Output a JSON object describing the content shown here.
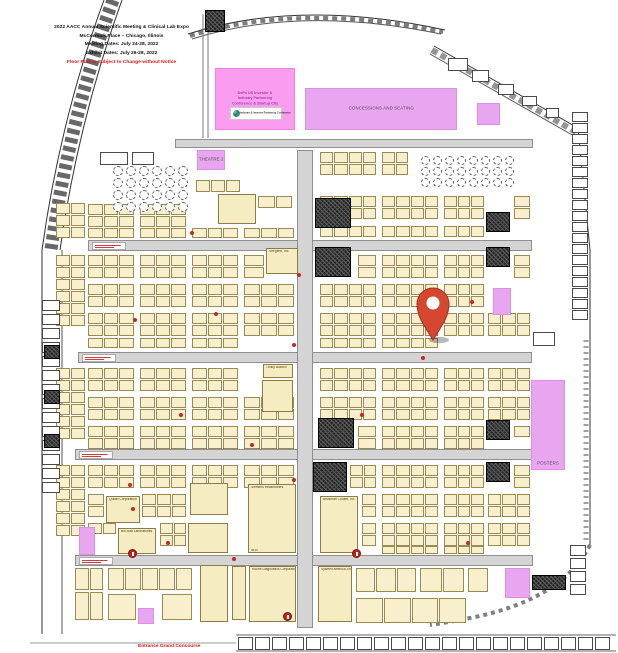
{
  "title": {
    "line1": "2022 AACC Annual Scientific Meeting & Clinical Lab Expo",
    "line2": "McCormick Place – Chicago, Illinois",
    "line3": "Meeting Dates: July 24-28, 2022",
    "line4": "Exhibit Dates: July 26-28, 2022",
    "notice": "Floor Plan is Subject to Change without Notice"
  },
  "labels": {
    "entrance": "Entrance Grand Concourse",
    "concessions": "CONCESSIONS AND SEATING",
    "theatre2": "THEATRE 2",
    "posters": "POSTERS",
    "dxpx_line1": "DxPx US Investor &",
    "dxpx_line2": "Industry Partnering",
    "dxpx_line3": "Conference & Startup City",
    "dxpx_logo": "Industry & Investor Partnering Conference"
  },
  "colors": {
    "booth_fill": "#f8efcd",
    "booth_border": "#9c8a52",
    "aisle_gray": "#d4d4d4",
    "zone_purple": "#e9a6f0",
    "zone_pink": "#fa9df0",
    "alert_red": "#e01212",
    "pin_red": "#d5472f"
  },
  "aisles": [
    [
      175,
      139,
      358,
      9
    ],
    [
      88,
      240,
      444,
      11
    ],
    [
      78,
      352,
      454,
      11
    ],
    [
      75,
      449,
      460,
      11
    ],
    [
      75,
      555,
      458,
      11
    ],
    [
      297,
      150,
      16,
      478
    ]
  ],
  "aisle_signs": [
    [
      92,
      242,
      34
    ],
    [
      82,
      354,
      34
    ],
    [
      79,
      451,
      34
    ],
    [
      79,
      557,
      34
    ]
  ],
  "strips": [
    [
      88,
      204,
      46,
      11,
      3
    ],
    [
      140,
      204,
      46,
      11,
      3
    ],
    [
      88,
      216,
      46,
      11,
      3
    ],
    [
      140,
      216,
      46,
      11,
      3
    ],
    [
      88,
      228,
      46,
      10,
      3
    ],
    [
      140,
      228,
      46,
      10,
      3
    ],
    [
      192,
      228,
      46,
      10,
      3
    ],
    [
      244,
      228,
      50,
      10,
      3
    ],
    [
      196,
      180,
      44,
      12,
      3
    ],
    [
      258,
      196,
      34,
      12,
      2
    ],
    [
      320,
      152,
      56,
      11,
      4
    ],
    [
      382,
      152,
      26,
      11,
      2
    ],
    [
      320,
      164,
      56,
      11,
      4
    ],
    [
      382,
      164,
      26,
      11,
      2
    ],
    [
      320,
      196,
      56,
      11,
      4
    ],
    [
      382,
      196,
      56,
      11,
      4
    ],
    [
      444,
      196,
      40,
      11,
      3
    ],
    [
      514,
      196,
      16,
      11,
      1
    ],
    [
      320,
      208,
      56,
      11,
      4
    ],
    [
      382,
      208,
      56,
      11,
      4
    ],
    [
      444,
      208,
      40,
      11,
      3
    ],
    [
      514,
      208,
      16,
      11,
      1
    ],
    [
      320,
      226,
      56,
      11,
      4
    ],
    [
      382,
      226,
      56,
      11,
      4
    ],
    [
      444,
      226,
      40,
      11,
      3
    ],
    [
      88,
      255,
      46,
      11,
      3
    ],
    [
      140,
      255,
      46,
      11,
      3
    ],
    [
      192,
      255,
      46,
      11,
      3
    ],
    [
      244,
      255,
      20,
      11,
      1
    ],
    [
      88,
      267,
      46,
      11,
      3
    ],
    [
      140,
      267,
      46,
      11,
      3
    ],
    [
      192,
      267,
      46,
      11,
      3
    ],
    [
      244,
      267,
      20,
      11,
      1
    ],
    [
      358,
      255,
      18,
      11,
      1
    ],
    [
      382,
      255,
      56,
      11,
      4
    ],
    [
      444,
      255,
      40,
      11,
      3
    ],
    [
      514,
      255,
      16,
      11,
      1
    ],
    [
      358,
      267,
      18,
      11,
      1
    ],
    [
      382,
      267,
      56,
      11,
      4
    ],
    [
      444,
      267,
      40,
      11,
      3
    ],
    [
      514,
      267,
      16,
      11,
      1
    ],
    [
      88,
      284,
      46,
      11,
      3
    ],
    [
      140,
      284,
      46,
      11,
      3
    ],
    [
      192,
      284,
      46,
      11,
      3
    ],
    [
      244,
      284,
      50,
      11,
      3
    ],
    [
      320,
      284,
      56,
      11,
      4
    ],
    [
      382,
      284,
      56,
      11,
      4
    ],
    [
      444,
      284,
      40,
      11,
      3
    ],
    [
      88,
      296,
      46,
      11,
      3
    ],
    [
      140,
      296,
      46,
      11,
      3
    ],
    [
      192,
      296,
      46,
      11,
      3
    ],
    [
      244,
      296,
      50,
      11,
      3
    ],
    [
      320,
      296,
      56,
      11,
      4
    ],
    [
      382,
      296,
      56,
      11,
      4
    ],
    [
      444,
      296,
      40,
      11,
      3
    ],
    [
      88,
      313,
      46,
      11,
      3
    ],
    [
      140,
      313,
      46,
      11,
      3
    ],
    [
      192,
      313,
      46,
      11,
      3
    ],
    [
      244,
      313,
      50,
      11,
      3
    ],
    [
      320,
      313,
      56,
      11,
      4
    ],
    [
      382,
      313,
      56,
      11,
      4
    ],
    [
      444,
      313,
      40,
      11,
      3
    ],
    [
      488,
      313,
      42,
      11,
      3
    ],
    [
      88,
      325,
      46,
      11,
      3
    ],
    [
      140,
      325,
      46,
      11,
      3
    ],
    [
      192,
      325,
      46,
      11,
      3
    ],
    [
      244,
      325,
      50,
      11,
      3
    ],
    [
      320,
      325,
      56,
      11,
      4
    ],
    [
      382,
      325,
      56,
      11,
      4
    ],
    [
      444,
      325,
      40,
      11,
      3
    ],
    [
      488,
      325,
      42,
      11,
      3
    ],
    [
      88,
      338,
      46,
      10,
      3
    ],
    [
      140,
      338,
      46,
      10,
      3
    ],
    [
      192,
      338,
      46,
      10,
      3
    ],
    [
      320,
      338,
      56,
      10,
      4
    ],
    [
      382,
      338,
      56,
      10,
      4
    ],
    [
      88,
      368,
      46,
      11,
      3
    ],
    [
      140,
      368,
      46,
      11,
      3
    ],
    [
      192,
      368,
      46,
      11,
      3
    ],
    [
      320,
      368,
      56,
      11,
      4
    ],
    [
      382,
      368,
      56,
      11,
      4
    ],
    [
      444,
      368,
      40,
      11,
      3
    ],
    [
      488,
      368,
      42,
      11,
      3
    ],
    [
      88,
      380,
      46,
      11,
      3
    ],
    [
      140,
      380,
      46,
      11,
      3
    ],
    [
      192,
      380,
      46,
      11,
      3
    ],
    [
      320,
      380,
      56,
      11,
      4
    ],
    [
      382,
      380,
      56,
      11,
      4
    ],
    [
      444,
      380,
      40,
      11,
      3
    ],
    [
      488,
      380,
      42,
      11,
      3
    ],
    [
      88,
      397,
      46,
      11,
      3
    ],
    [
      140,
      397,
      46,
      11,
      3
    ],
    [
      192,
      397,
      46,
      11,
      3
    ],
    [
      244,
      397,
      50,
      11,
      3
    ],
    [
      320,
      397,
      56,
      11,
      4
    ],
    [
      382,
      397,
      56,
      11,
      4
    ],
    [
      444,
      397,
      40,
      11,
      3
    ],
    [
      488,
      397,
      42,
      11,
      3
    ],
    [
      88,
      409,
      46,
      11,
      3
    ],
    [
      140,
      409,
      46,
      11,
      3
    ],
    [
      192,
      409,
      46,
      11,
      3
    ],
    [
      244,
      409,
      50,
      11,
      3
    ],
    [
      320,
      409,
      56,
      11,
      4
    ],
    [
      382,
      409,
      56,
      11,
      4
    ],
    [
      444,
      409,
      40,
      11,
      3
    ],
    [
      488,
      409,
      42,
      11,
      3
    ],
    [
      88,
      426,
      46,
      11,
      3
    ],
    [
      140,
      426,
      46,
      11,
      3
    ],
    [
      192,
      426,
      46,
      11,
      3
    ],
    [
      244,
      426,
      50,
      11,
      3
    ],
    [
      358,
      426,
      18,
      11,
      1
    ],
    [
      382,
      426,
      56,
      11,
      4
    ],
    [
      444,
      426,
      40,
      11,
      3
    ],
    [
      514,
      426,
      16,
      11,
      1
    ],
    [
      88,
      438,
      46,
      11,
      3
    ],
    [
      140,
      438,
      46,
      11,
      3
    ],
    [
      192,
      438,
      46,
      11,
      3
    ],
    [
      244,
      438,
      50,
      11,
      3
    ],
    [
      358,
      438,
      18,
      11,
      1
    ],
    [
      382,
      438,
      56,
      11,
      4
    ],
    [
      444,
      438,
      40,
      11,
      3
    ],
    [
      88,
      465,
      46,
      11,
      3
    ],
    [
      140,
      465,
      46,
      11,
      3
    ],
    [
      192,
      465,
      46,
      11,
      3
    ],
    [
      244,
      465,
      50,
      11,
      3
    ],
    [
      350,
      465,
      26,
      11,
      2
    ],
    [
      382,
      465,
      56,
      11,
      4
    ],
    [
      444,
      465,
      40,
      11,
      3
    ],
    [
      514,
      465,
      16,
      11,
      1
    ],
    [
      88,
      477,
      46,
      11,
      3
    ],
    [
      140,
      477,
      46,
      11,
      3
    ],
    [
      192,
      477,
      46,
      11,
      3
    ],
    [
      244,
      477,
      50,
      11,
      3
    ],
    [
      350,
      477,
      26,
      11,
      2
    ],
    [
      382,
      477,
      56,
      11,
      4
    ],
    [
      444,
      477,
      40,
      11,
      3
    ],
    [
      514,
      477,
      16,
      11,
      1
    ],
    [
      88,
      494,
      16,
      11,
      1
    ],
    [
      142,
      494,
      44,
      11,
      3
    ],
    [
      362,
      494,
      14,
      11,
      1
    ],
    [
      382,
      494,
      56,
      11,
      4
    ],
    [
      444,
      494,
      40,
      11,
      3
    ],
    [
      488,
      494,
      42,
      11,
      3
    ],
    [
      88,
      506,
      16,
      11,
      1
    ],
    [
      142,
      506,
      44,
      11,
      3
    ],
    [
      362,
      506,
      14,
      11,
      1
    ],
    [
      382,
      506,
      56,
      11,
      4
    ],
    [
      444,
      506,
      40,
      11,
      3
    ],
    [
      488,
      506,
      42,
      11,
      3
    ],
    [
      88,
      523,
      28,
      11,
      2
    ],
    [
      160,
      523,
      26,
      11,
      2
    ],
    [
      362,
      523,
      14,
      11,
      1
    ],
    [
      382,
      523,
      56,
      11,
      4
    ],
    [
      444,
      523,
      40,
      11,
      3
    ],
    [
      488,
      523,
      42,
      11,
      3
    ],
    [
      160,
      535,
      26,
      11,
      2
    ],
    [
      362,
      535,
      14,
      11,
      1
    ],
    [
      382,
      535,
      56,
      11,
      4
    ],
    [
      444,
      535,
      40,
      11,
      3
    ],
    [
      488,
      535,
      42,
      11,
      3
    ],
    [
      382,
      546,
      56,
      8,
      4
    ],
    [
      444,
      546,
      40,
      8,
      3
    ],
    [
      75,
      568,
      28,
      22,
      2
    ],
    [
      108,
      568,
      84,
      22,
      5
    ],
    [
      356,
      568,
      60,
      24,
      3
    ],
    [
      420,
      568,
      44,
      24,
      2
    ],
    [
      468,
      568,
      20,
      24,
      1
    ],
    [
      75,
      592,
      28,
      28,
      2
    ],
    [
      108,
      594,
      28,
      26,
      1
    ],
    [
      162,
      594,
      30,
      26,
      1
    ],
    [
      356,
      598,
      110,
      25,
      4
    ]
  ],
  "clusters": [
    {
      "x": 56,
      "y": 203,
      "cols": 2,
      "rows": 3,
      "bw": 14,
      "bh": 11,
      "g": 1,
      "style": "booth"
    },
    {
      "x": 56,
      "y": 255,
      "cols": 2,
      "rows": 6,
      "bw": 14,
      "bh": 11,
      "g": 1,
      "style": "booth"
    },
    {
      "x": 56,
      "y": 368,
      "cols": 2,
      "rows": 6,
      "bw": 14,
      "bh": 11,
      "g": 1,
      "style": "booth"
    },
    {
      "x": 56,
      "y": 465,
      "cols": 2,
      "rows": 6,
      "bw": 14,
      "bh": 11,
      "g": 1,
      "style": "booth"
    },
    {
      "x": 572,
      "y": 112,
      "cols": 1,
      "rows": 19,
      "bw": 16,
      "bh": 10,
      "g": 1,
      "style": "room"
    },
    {
      "x": 570,
      "y": 545,
      "cols": 1,
      "rows": 4,
      "bw": 16,
      "bh": 11,
      "g": 2,
      "style": "room"
    },
    {
      "x": 42,
      "y": 300,
      "cols": 1,
      "rows": 14,
      "bw": 18,
      "bh": 11,
      "g": 3,
      "style": "room"
    },
    {
      "x": 238,
      "y": 637,
      "cols": 22,
      "rows": 1,
      "bw": 15,
      "bh": 13,
      "g": 2,
      "style": "room"
    }
  ],
  "rooms": [
    [
      100,
      152,
      28,
      13
    ],
    [
      132,
      152,
      22,
      13
    ],
    [
      448,
      58,
      20,
      13
    ],
    [
      472,
      70,
      17,
      12
    ],
    [
      498,
      84,
      16,
      11
    ],
    [
      522,
      96,
      15,
      10
    ],
    [
      546,
      108,
      13,
      10
    ],
    [
      533,
      332,
      22,
      14
    ]
  ],
  "utilities": [
    [
      315,
      198,
      36,
      30
    ],
    [
      315,
      247,
      36,
      30
    ],
    [
      318,
      418,
      36,
      30
    ],
    [
      313,
      462,
      34,
      30
    ],
    [
      486,
      212,
      24,
      20
    ],
    [
      486,
      247,
      24,
      20
    ],
    [
      486,
      420,
      24,
      20
    ],
    [
      486,
      462,
      24,
      20
    ],
    [
      532,
      575,
      34,
      15
    ],
    [
      205,
      10,
      20,
      22
    ],
    [
      44,
      345,
      16,
      14
    ],
    [
      44,
      390,
      16,
      14
    ],
    [
      44,
      434,
      16,
      14
    ]
  ],
  "big_booths": [
    {
      "name": "Seegene, Inc.",
      "num": "",
      "x": 266,
      "y": 248,
      "w": 32,
      "h": 26
    },
    {
      "name": "",
      "num": "",
      "x": 218,
      "y": 194,
      "w": 38,
      "h": 30
    },
    {
      "name": "Trinity Biotech",
      "num": "",
      "x": 263,
      "y": 364,
      "w": 30,
      "h": 14
    },
    {
      "name": "",
      "num": "",
      "x": 262,
      "y": 380,
      "w": 31,
      "h": 32
    },
    {
      "name": "",
      "num": "",
      "x": 190,
      "y": 483,
      "w": 38,
      "h": 32
    },
    {
      "name": "",
      "num": "",
      "x": 188,
      "y": 523,
      "w": 40,
      "h": 30
    },
    {
      "name": "Siemens Healthineers",
      "num": "3613",
      "x": 248,
      "y": 484,
      "w": 48,
      "h": 69
    },
    {
      "name": "Beckman Coulter, Inc.",
      "num": "",
      "x": 320,
      "y": 496,
      "w": 38,
      "h": 57
    },
    {
      "name": "Quidel Corporation",
      "num": "",
      "x": 106,
      "y": 496,
      "w": 34,
      "h": 27
    },
    {
      "name": "Bio-Rad Laboratories",
      "num": "",
      "x": 118,
      "y": 528,
      "w": 38,
      "h": 26
    },
    {
      "name": "",
      "num": "",
      "x": 200,
      "y": 565,
      "w": 28,
      "h": 57
    },
    {
      "name": "",
      "num": "",
      "x": 232,
      "y": 566,
      "w": 14,
      "h": 54
    },
    {
      "name": "Roche Diagnostics Corporation",
      "num": "",
      "x": 249,
      "y": 566,
      "w": 47,
      "h": 56
    },
    {
      "name": "Sysmex America, Inc.",
      "num": "",
      "x": 318,
      "y": 566,
      "w": 34,
      "h": 56
    }
  ],
  "purple_zones": [
    {
      "id": "concessions",
      "x": 305,
      "y": 88,
      "w": 152,
      "h": 42
    },
    {
      "id": "theatre2",
      "x": 197,
      "y": 150,
      "w": 28,
      "h": 20
    },
    {
      "id": "small-top-right",
      "x": 477,
      "y": 103,
      "w": 23,
      "h": 22
    },
    {
      "id": "small-mid-right",
      "x": 493,
      "y": 288,
      "w": 18,
      "h": 27
    },
    {
      "id": "posters",
      "x": 531,
      "y": 380,
      "w": 34,
      "h": 90
    },
    {
      "id": "small-left",
      "x": 79,
      "y": 527,
      "w": 16,
      "h": 28
    },
    {
      "id": "small-bottom-right",
      "x": 505,
      "y": 568,
      "w": 25,
      "h": 30
    },
    {
      "id": "small-bottom",
      "x": 138,
      "y": 608,
      "w": 16,
      "h": 16
    }
  ],
  "dxpx_zone": {
    "x": 215,
    "y": 68,
    "w": 80,
    "h": 62
  },
  "tables": [
    {
      "x": 113,
      "y": 166,
      "cols": 6,
      "rows": 4,
      "d": 10,
      "gx": 3,
      "gy": 2
    },
    {
      "x": 421,
      "y": 156,
      "cols": 8,
      "rows": 3,
      "d": 9,
      "gx": 3,
      "gy": 2
    }
  ],
  "red_dots": [
    [
      297,
      273
    ],
    [
      214,
      312
    ],
    [
      133,
      318
    ],
    [
      292,
      343
    ],
    [
      179,
      413
    ],
    [
      131,
      507
    ],
    [
      166,
      541
    ],
    [
      292,
      478
    ],
    [
      421,
      356
    ],
    [
      250,
      443
    ],
    [
      470,
      300
    ],
    [
      190,
      231
    ],
    [
      466,
      541
    ],
    [
      360,
      413
    ],
    [
      232,
      557
    ],
    [
      128,
      483
    ]
  ],
  "aisle_markers": [
    [
      352,
      549
    ],
    [
      283,
      612
    ],
    [
      128,
      549
    ]
  ],
  "pin": {
    "x": 433,
    "y": 304
  }
}
